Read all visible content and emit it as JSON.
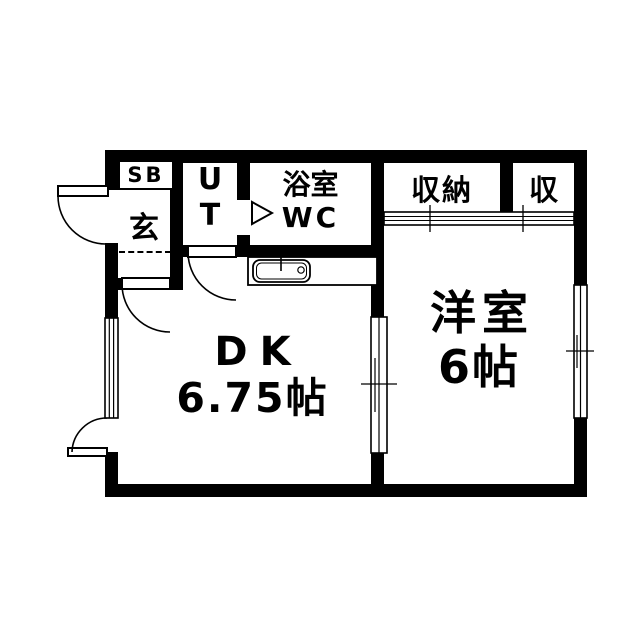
{
  "rooms": {
    "shoe_box": {
      "label": "SB"
    },
    "entrance": {
      "label": "玄"
    },
    "utility": {
      "line1": "U",
      "line2": "T"
    },
    "bathroom": {
      "line1": "浴室",
      "line2": "WC"
    },
    "closet_main": {
      "label": "収納"
    },
    "closet_sub": {
      "label": "収"
    },
    "dining_kitchen": {
      "line1": "DK",
      "line2": "6.75帖"
    },
    "western_room": {
      "line1": "洋室",
      "line2": "6帖"
    }
  },
  "colors": {
    "wall": "#000000",
    "background": "#ffffff",
    "text": "#000000"
  }
}
